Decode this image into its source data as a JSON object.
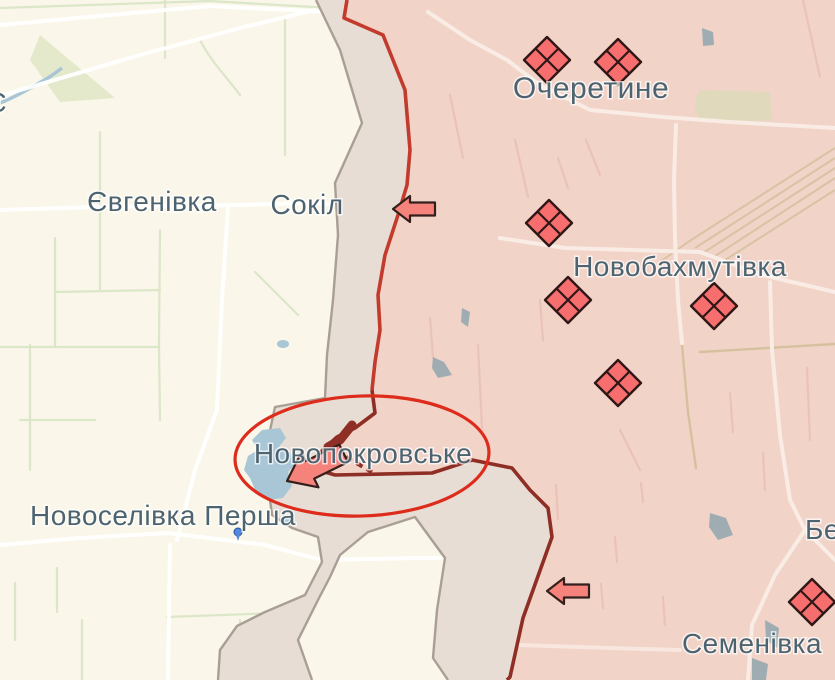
{
  "colors": {
    "friendly_fill": "#faf6e9",
    "contested_fill": "#e8ddd5",
    "occupied_fill": "#f2d3c8",
    "frontline_red": "#c33b2d",
    "frontline_dark": "#8f2e24",
    "annotation_red": "#dd2b1c",
    "gray_border": "#a59a90",
    "marker_fill": "#f66e6e",
    "marker_stroke": "#2f1717",
    "arrow_fill": "#f5837b",
    "arrow_stroke": "#33201c",
    "label_color": "#4d6470",
    "road_white": "#ffffff",
    "road_pink": "#f9ece5",
    "field_green": "#d8e4c4",
    "field_pink": "#e9c3b6",
    "water_blue": "#a9c6d6",
    "water_gray": "#9fadb2",
    "rail_tan": "#d5c19e",
    "green_patch": "#dfe6c4",
    "green_patch2": "#ddd9ba",
    "pin_blue": "#5187e0"
  },
  "labels": [
    {
      "id": "ocheretyne",
      "text": "Очеретине",
      "x": 591,
      "y": 98,
      "size": 30,
      "anchor": "middle"
    },
    {
      "id": "novobakhmutivka",
      "text": "Новобахмутівка",
      "x": 680,
      "y": 276,
      "size": 28,
      "anchor": "middle"
    },
    {
      "id": "novopokrovske",
      "text": "Новопокровське",
      "x": 363,
      "y": 463,
      "size": 28,
      "anchor": "middle"
    },
    {
      "id": "yevhenivka",
      "text": "Євгенівка",
      "x": 152,
      "y": 211,
      "size": 28,
      "anchor": "middle"
    },
    {
      "id": "sokil",
      "text": "Сокіл",
      "x": 307,
      "y": 214,
      "size": 28,
      "anchor": "middle"
    },
    {
      "id": "novoselivka-persha",
      "text": "Новоселівка Перша",
      "x": 163,
      "y": 525,
      "size": 28,
      "anchor": "middle"
    },
    {
      "id": "semenivka",
      "text": "Семенівка",
      "x": 752,
      "y": 653,
      "size": 28,
      "anchor": "middle"
    },
    {
      "id": "be-clipped-right",
      "text": "Бе",
      "x": 805,
      "y": 539,
      "size": 28,
      "anchor": "start"
    },
    {
      "id": "clipped-left",
      "text": "Є",
      "x": 7,
      "y": 112,
      "size": 28,
      "anchor": "end"
    }
  ],
  "markers": {
    "shape": "quartered-diamond",
    "size": 46,
    "positions": [
      {
        "x": 547,
        "y": 60
      },
      {
        "x": 618,
        "y": 62
      },
      {
        "x": 549,
        "y": 223
      },
      {
        "x": 568,
        "y": 300
      },
      {
        "x": 714,
        "y": 306
      },
      {
        "x": 618,
        "y": 383
      },
      {
        "x": 812,
        "y": 602
      }
    ]
  },
  "arrows": [
    {
      "id": "attack-arrow-sokil",
      "x": 393,
      "y": 209,
      "rotate": 0,
      "scale": 1.0
    },
    {
      "id": "attack-arrow-south",
      "x": 547,
      "y": 591,
      "rotate": 0,
      "scale": 1.0
    },
    {
      "id": "attack-arrow-novopokrovske",
      "x": 287,
      "y": 481,
      "rotate": -26,
      "scale": 1.5
    }
  ],
  "annotation_ellipse": {
    "cx": 362,
    "cy": 456,
    "rx": 127,
    "ry": 60,
    "rotate": -2
  },
  "pin": {
    "x": 238,
    "y": 532
  }
}
